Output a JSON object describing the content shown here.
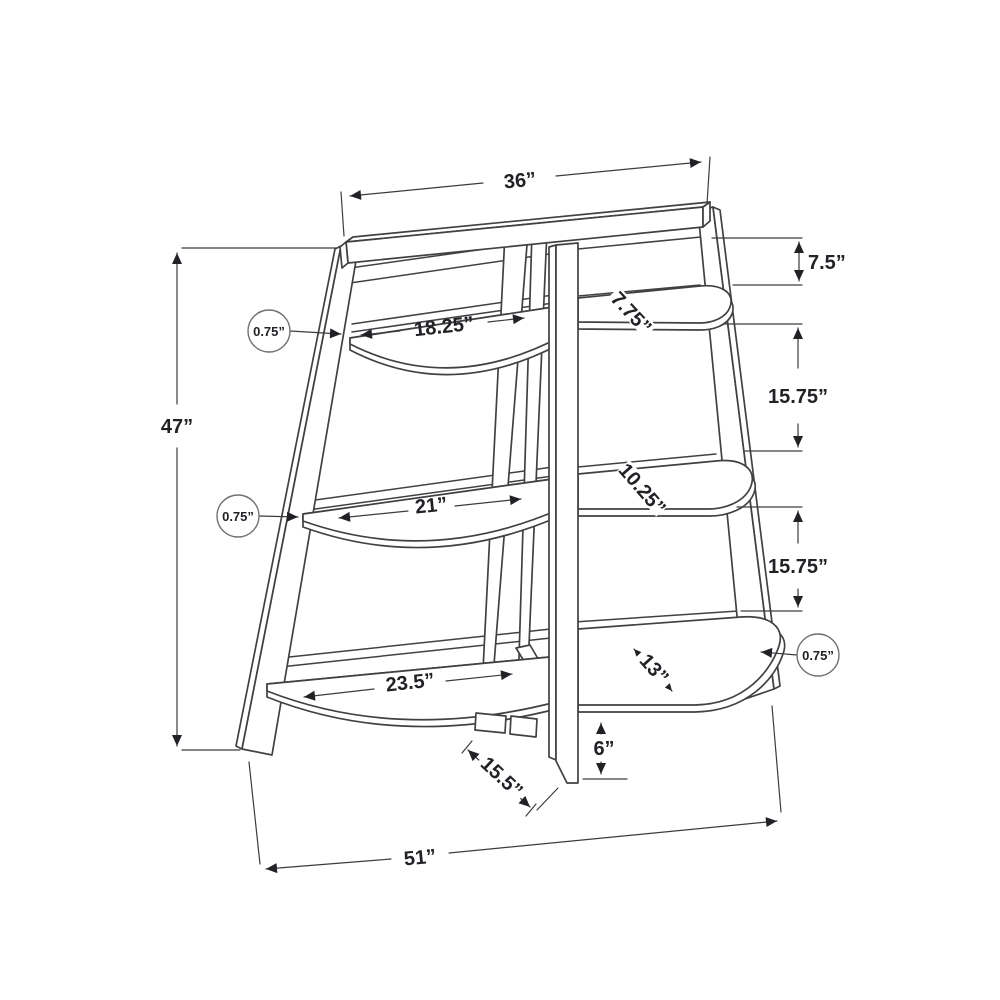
{
  "figure": {
    "type": "furniture-dimension-diagram",
    "subject": "3-tier corner ladder accent shelf, line drawing with dimension annotations",
    "units": "inches",
    "colors": {
      "background": "#ffffff",
      "structure_line": "#414144",
      "dimension_line": "#3c3c3e",
      "label_text": "#232126"
    }
  },
  "labels": {
    "top_width": "36”",
    "overall_height": "47”",
    "base_width": "51”",
    "top_offset": "7.5”",
    "spacing_upper": "15.75”",
    "spacing_lower": "15.75”",
    "foot_clearance": "6”",
    "base_depth": "15.5”",
    "shelf_top_width": "18.25”",
    "shelf_middle_width": "21”",
    "shelf_bottom_width": "23.5”",
    "shelf_top_depth": "7.75”",
    "shelf_middle_depth": "10.25”",
    "shelf_bottom_depth": "13”",
    "thickness_top_left": "0.75”",
    "thickness_middle_left": "0.75”",
    "thickness_bottom_right": "0.75”"
  }
}
